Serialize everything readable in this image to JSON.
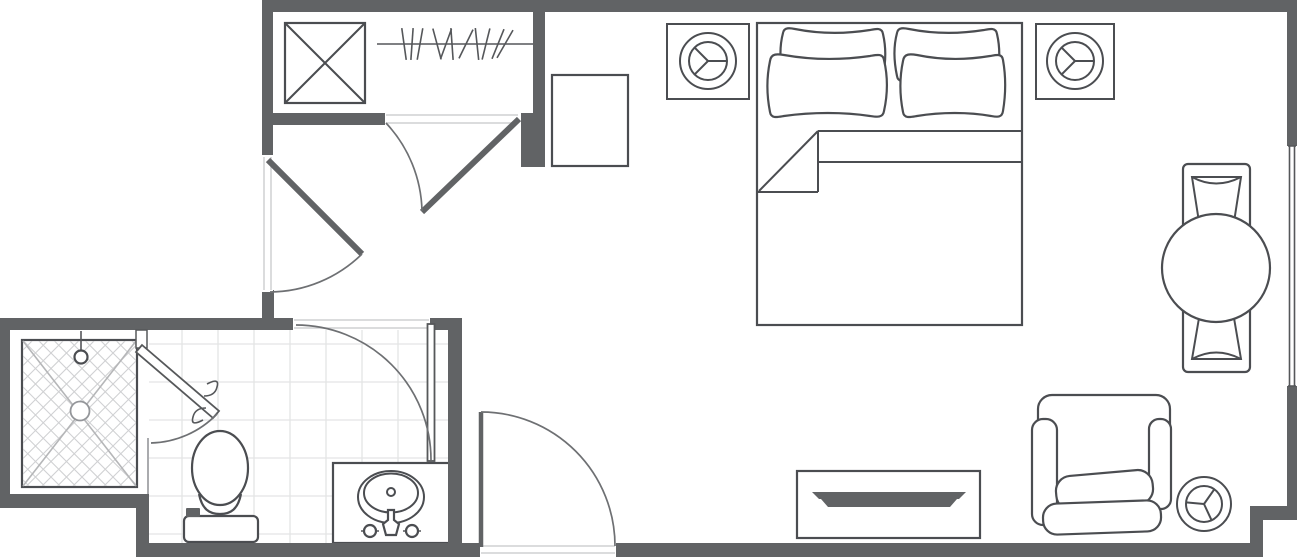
{
  "meta": {
    "drawing_type": "residential studio floor plan, top view, line drawing",
    "canvas": {
      "width": 1300,
      "height": 557
    },
    "visible_text": ""
  },
  "palette": {
    "wall": "#616365",
    "outline": "#4b4d51",
    "outline2": "#55575a",
    "arc": "#6e7073",
    "jamb": "#cfd0d2",
    "tile": "#e3e4e5",
    "lattice": "#d0d1d3",
    "showerx": "#b5b6b8",
    "bg": "#ffffff"
  },
  "inventory": {
    "rooms": [
      "entry-closet-corridor",
      "bedroom-living-area",
      "bathroom"
    ],
    "symbols": [
      {
        "name": "closet-shelf-unit",
        "glyph": "square-with-x"
      },
      {
        "name": "closet-hanger-rod",
        "glyph": "rod-with-hangers"
      },
      {
        "name": "dresser-cabinet",
        "glyph": "plain-square"
      },
      {
        "name": "ceiling-fixture-left",
        "glyph": "circle-in-square-3-spokes"
      },
      {
        "name": "ceiling-fixture-right",
        "glyph": "circle-in-square-3-spokes"
      },
      {
        "name": "floor-fixture-side-table",
        "glyph": "circle-3-spokes"
      },
      {
        "name": "double-bed",
        "pillows": 4,
        "blanket_fold": true
      },
      {
        "name": "round-dining-table",
        "chairs": 2
      },
      {
        "name": "tv-console",
        "glyph": "rect-with-flat-tv"
      },
      {
        "name": "armchair"
      },
      {
        "name": "shower",
        "glyph": "pan-with-x-and-lattice",
        "parts": [
          "shower-head",
          "drain",
          "hinged-glass-door"
        ]
      },
      {
        "name": "toilet"
      },
      {
        "name": "sink-vanity",
        "parts": [
          "basin",
          "faucet",
          "two-handles"
        ]
      }
    ],
    "doors": [
      {
        "name": "closet-door",
        "type": "swing"
      },
      {
        "name": "corridor-door",
        "type": "swing"
      },
      {
        "name": "bathroom-door",
        "type": "swing"
      },
      {
        "name": "entry-door",
        "type": "swing"
      },
      {
        "name": "shower-door",
        "type": "swing-with-handle"
      }
    ],
    "windows": [
      {
        "name": "right-wall-window",
        "glyph": "double-line-glazing"
      }
    ]
  },
  "closet": {
    "rod": {
      "x1": 377,
      "x2": 533,
      "y": 44
    },
    "hangers": [
      {
        "x": 404,
        "a": -8
      },
      {
        "x": 412,
        "a": 4
      },
      {
        "x": 420,
        "a": 10
      },
      {
        "x": 437,
        "a": -15
      },
      {
        "x": 446,
        "a": 20
      },
      {
        "x": 452,
        "a": -4
      },
      {
        "x": 466,
        "a": 26
      },
      {
        "x": 477,
        "a": -6
      },
      {
        "x": 486,
        "a": 14
      },
      {
        "x": 498,
        "a": 22
      },
      {
        "x": 505,
        "a": 30
      }
    ]
  },
  "shower_lattice": {
    "spacing": 15.5,
    "clip": {
      "x": 23,
      "y": 341,
      "w": 113,
      "h": 145
    }
  },
  "bath_tiles": {
    "xs": [
      182,
      218,
      254,
      290,
      326,
      362,
      398,
      434
    ],
    "ys": [
      344,
      382,
      420,
      458,
      496,
      534
    ],
    "x0": 149,
    "x1": 448,
    "y0": 330,
    "y1": 543
  }
}
